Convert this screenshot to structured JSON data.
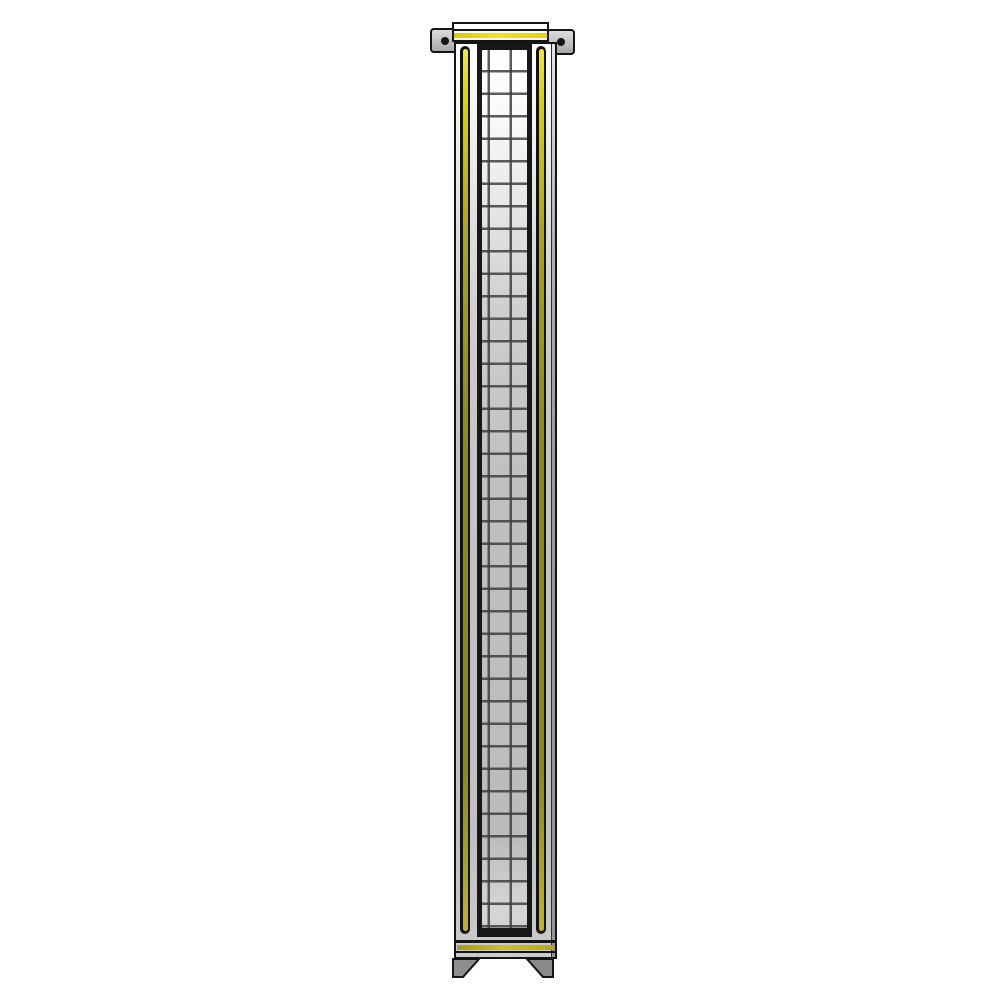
{
  "image": {
    "description": "3D product render of a tall narrow partition panel with a wire-mesh insert, yellow accent trim strips, a top cap with two drilled mounting brackets, a base rail with yellow stripe, and two angled feet, on a plain white background",
    "object": "mesh-partition-panel"
  },
  "colors": {
    "background": "#ffffff",
    "outline": "#141414",
    "accent-yellow": "#e0d400",
    "accent-yellow-dark": "#8e8a14",
    "frame-gray": "#c4c4c4",
    "mesh-cell-light": "#ececec",
    "mesh-cell-gray": "#bfbfbf",
    "mesh-line": "#3e3e3e",
    "bracket-gray": "#c0c0c0",
    "side-shade": "#9b9b9b",
    "foot-gray": "#8e8e8e"
  },
  "parts": {
    "top_cap": "top cap rail with yellow stripe",
    "bracket_left": "left mounting bracket with bolt hole",
    "bracket_right": "right mounting bracket with bolt hole",
    "frame": "panel frame, white fading to gray",
    "groove_left": "left frame groove with yellow insert",
    "groove_right": "right frame groove with yellow insert",
    "mesh_window": "central wire mesh window, grid of squares",
    "base_rail": "bottom rail with yellow stripe",
    "foot_left": "left angled foot",
    "foot_right": "right angled foot"
  }
}
